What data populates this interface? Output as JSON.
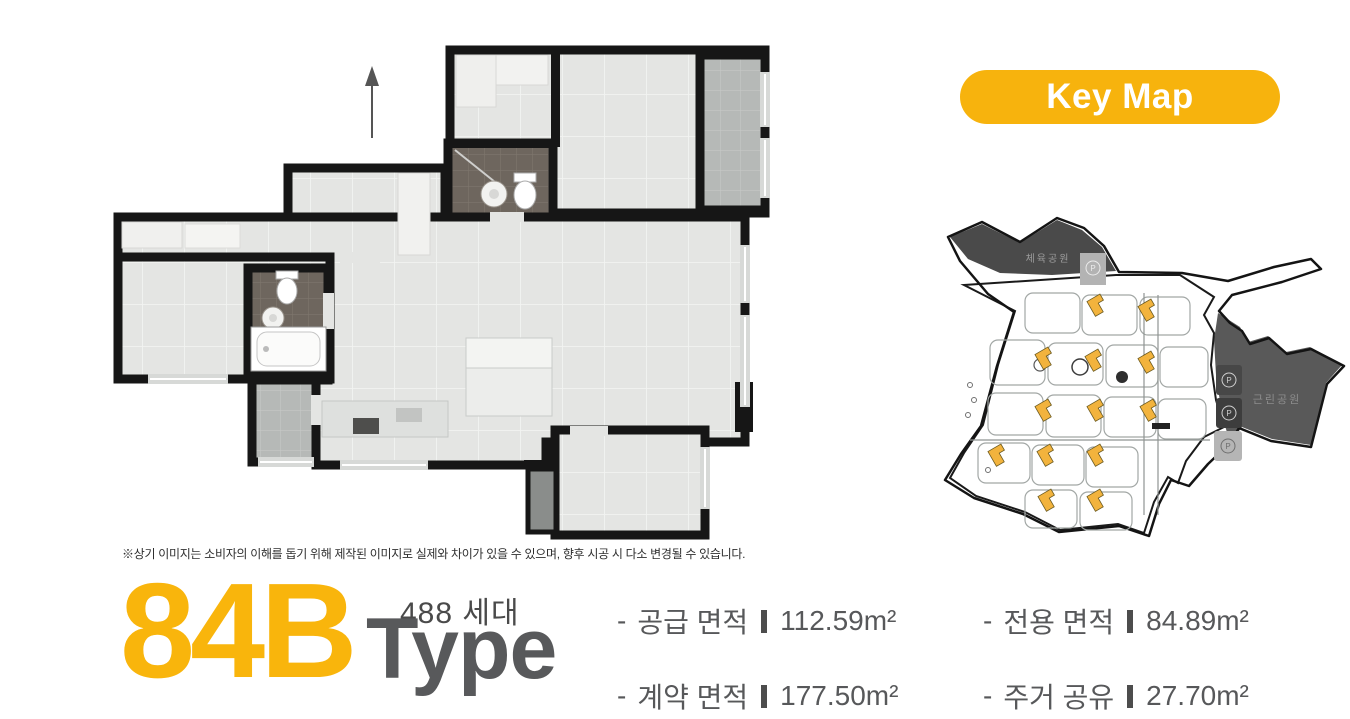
{
  "key_map": {
    "label": "Key Map"
  },
  "floor_plan": {
    "disclaimer": "※상기 이미지는 소비자의 이해를 돕기 위해 제작된 이미지로 실제와 차이가 있을 수 있으며, 향후 시공 시 다소 변경될 수 있습니다."
  },
  "unit": {
    "type_code": "84B",
    "type_label": "Type",
    "households": "488 세대",
    "accent_color": "#F9B50C",
    "type_gray": "#58595B"
  },
  "specs": [
    {
      "prefix": "-",
      "label": "공급 면적",
      "value": "112.59m²"
    },
    {
      "prefix": "-",
      "label": "전용 면적",
      "value": "84.89m²"
    },
    {
      "prefix": "-",
      "label": "계약 면적",
      "value": "177.50m²"
    },
    {
      "prefix": "-",
      "label": "주거 공유",
      "value": "27.70m²"
    }
  ],
  "site_map": {
    "park_top_label": "체육공원",
    "park_right_label": "근린공원",
    "parking_label": "P",
    "highlight_color": "#F2B33D",
    "highlighted_building_count": 13
  }
}
